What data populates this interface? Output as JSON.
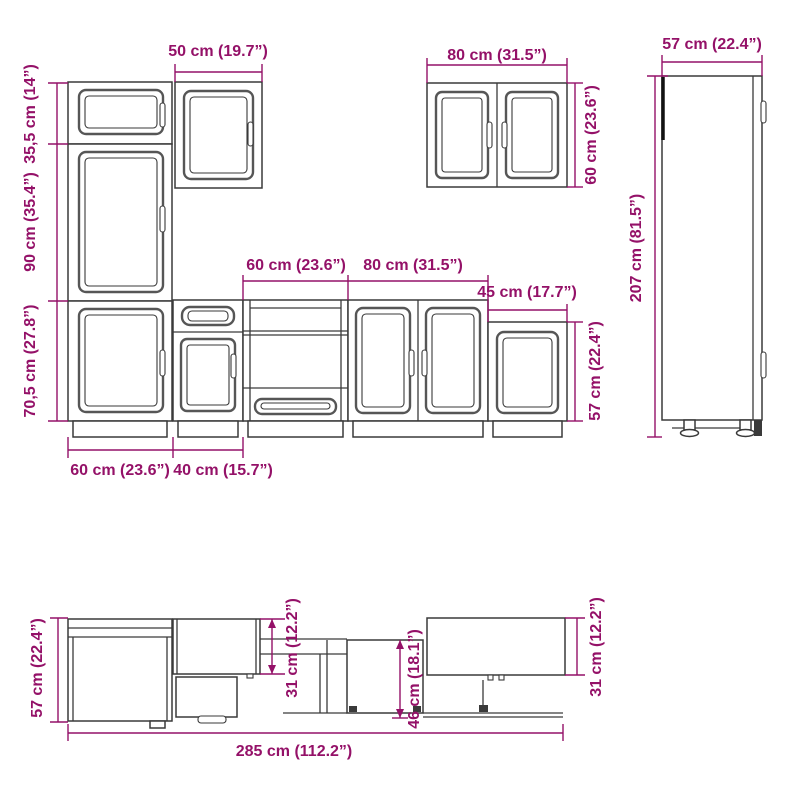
{
  "title": "Kitchen cabinet set dimension diagram",
  "colors": {
    "dimension": "#941168",
    "line": "#3a3a3a"
  },
  "views": {
    "front": {
      "dims": {
        "wall50_width": "50 cm (19.7”)",
        "tall_top_height": "35,5 cm (14”)",
        "tall_mid_height": "90 cm (35.4”)",
        "base_height": "70,5 cm (27.8”)",
        "base60_width": "60 cm (23.6”)",
        "base40_width": "40 cm (15.7”)",
        "oven60_width": "60 cm (23.6”)",
        "base80_width": "80 cm (31.5”)",
        "end45_width": "45 cm (17.7”)",
        "wall80_width": "80 cm (31.5”)",
        "wall60_height": "60 cm (23.6”)",
        "end57_height": "57 cm (22.4”)"
      }
    },
    "side": {
      "dims": {
        "depth57": "57 cm (22.4”)",
        "height207": "207 cm (81.5”)"
      }
    },
    "plan": {
      "dims": {
        "depth57": "57 cm (22.4”)",
        "wall31_left": "31 cm (12.2”)",
        "base46_depth": "46 cm (18.1”)",
        "wall31_right": "31 cm (12.2”)",
        "total285_width": "285 cm (112.2”)"
      }
    }
  }
}
